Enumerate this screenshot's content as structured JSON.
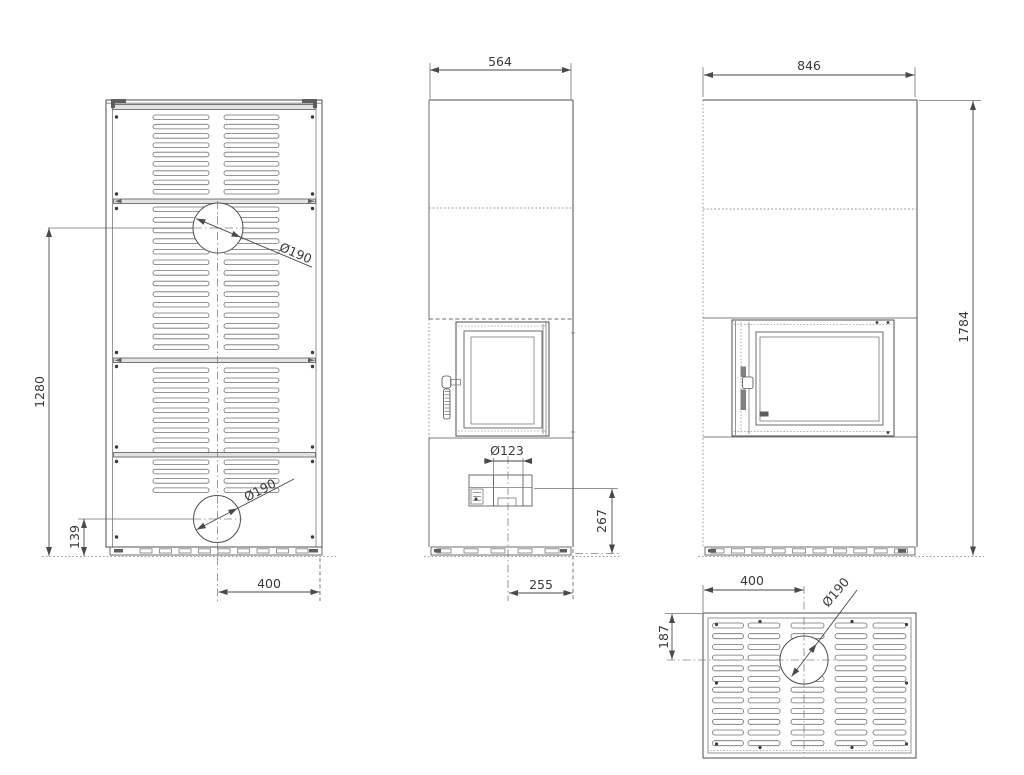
{
  "views": {
    "rear": {
      "dims": {
        "height_to_upper_flue": "1280",
        "lower_flue_height": "139",
        "flue_horizontal_offset": "400",
        "upper_flue_diameter": "Ø190",
        "lower_flue_diameter": "Ø190"
      }
    },
    "side": {
      "dims": {
        "depth": "564",
        "air_inlet_diameter": "Ø123",
        "air_inlet_center_height": "267",
        "air_inlet_center_offset": "255"
      }
    },
    "front": {
      "dims": {
        "width": "846",
        "height": "1784"
      }
    },
    "top": {
      "dims": {
        "flue_center_from_left": "400",
        "flue_center_from_top": "187",
        "flue_diameter": "Ø190"
      }
    }
  },
  "colors": {
    "line": "#4d4d4d",
    "text": "#3a3a3a",
    "background": "#ffffff"
  }
}
